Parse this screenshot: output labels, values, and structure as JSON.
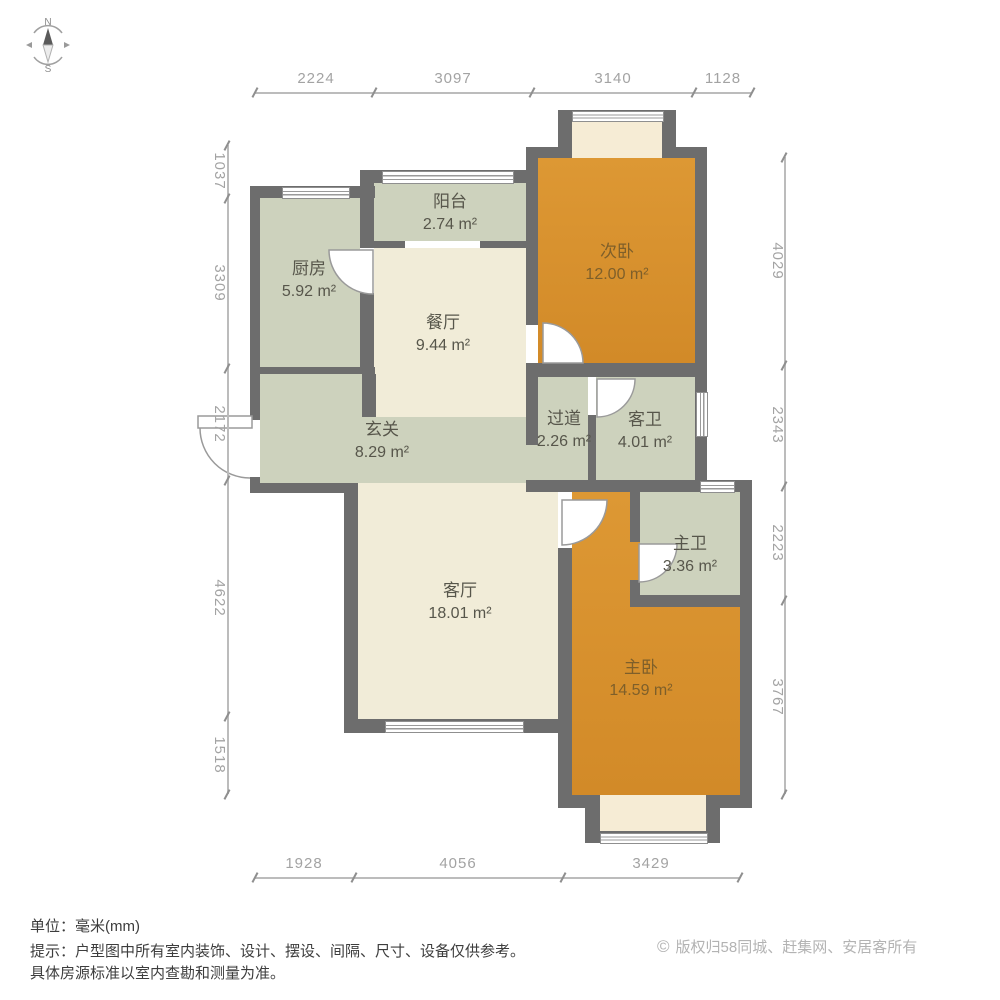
{
  "compass": {
    "north_label": "N",
    "south_label": "S"
  },
  "rooms": [
    {
      "name": "阳台",
      "area": "2.74 m²"
    },
    {
      "name": "厨房",
      "area": "5.92 m²"
    },
    {
      "name": "餐厅",
      "area": "9.44 m²"
    },
    {
      "name": "次卧",
      "area": "12.00 m²"
    },
    {
      "name": "过道",
      "area": "2.26 m²"
    },
    {
      "name": "客卫",
      "area": "4.01 m²"
    },
    {
      "name": "玄关",
      "area": "8.29 m²"
    },
    {
      "name": "客厅",
      "area": "18.01 m²"
    },
    {
      "name": "主卫",
      "area": "3.36 m²"
    },
    {
      "name": "主卧",
      "area": "14.59 m²"
    }
  ],
  "dimensions": {
    "top": [
      "2224",
      "3097",
      "3140",
      "1128"
    ],
    "left": [
      "1037",
      "3309",
      "2172",
      "4622",
      "1518"
    ],
    "right": [
      "4029",
      "2343",
      "2223",
      "3767"
    ],
    "bottom": [
      "1928",
      "4056",
      "3429"
    ]
  },
  "footer": {
    "unit": "单位：毫米(mm)",
    "notice1": "提示：户型图中所有室内装饰、设计、摆设、间隔、尺寸、设备仅供参考。",
    "notice2": "具体房源标准以室内查勘和测量为准。",
    "copyright_symbol": "©",
    "copyright": "版权归58同城、赶集网、安居客所有"
  },
  "colors": {
    "wall": "#6d6d6d",
    "light_room": "#cdd2bd",
    "warm_room": "#f1ecd8",
    "bedroom": "#d8922f",
    "bay": "#f6ecd5"
  }
}
